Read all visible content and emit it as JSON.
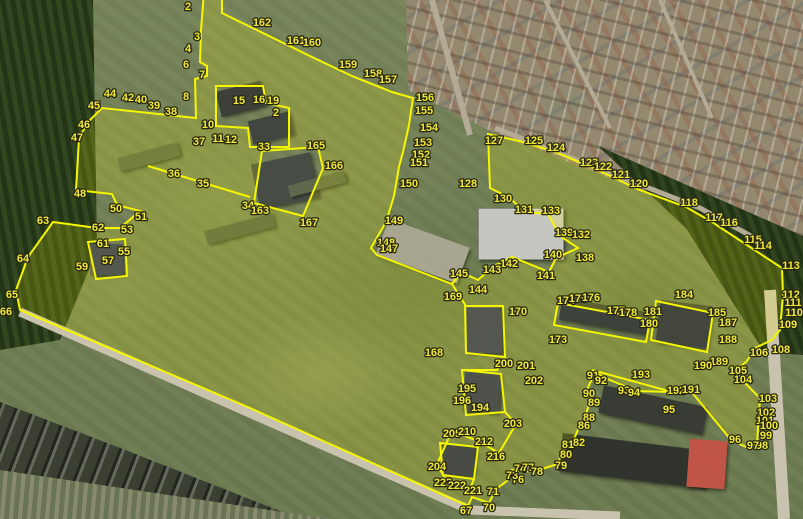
{
  "map": {
    "description": "Aerial cadastral survey overlay with numbered parcel vertices",
    "colors": {
      "boundary": "#f6f600",
      "parcel_fill": "rgba(255,255,0,0.17)",
      "label_text": "#f0e93a",
      "label_outline": "#262612",
      "road": "#c9c2ae",
      "road_minor": "#b3ab95"
    },
    "points": [
      [
        "2",
        188,
        6
      ],
      [
        "162",
        262,
        22
      ],
      [
        "3",
        197,
        36
      ],
      [
        "4",
        188,
        48
      ],
      [
        "6",
        186,
        64
      ],
      [
        "7",
        202,
        74
      ],
      [
        "8",
        186,
        96
      ],
      [
        "44",
        110,
        93
      ],
      [
        "45",
        94,
        105
      ],
      [
        "42",
        128,
        97
      ],
      [
        "40",
        141,
        99
      ],
      [
        "39",
        154,
        105
      ],
      [
        "38",
        171,
        111
      ],
      [
        "46",
        84,
        124
      ],
      [
        "47",
        77,
        137
      ],
      [
        "48",
        80,
        193
      ],
      [
        "50",
        116,
        208
      ],
      [
        "51",
        141,
        216
      ],
      [
        "62",
        98,
        227
      ],
      [
        "53",
        127,
        229
      ],
      [
        "63",
        43,
        220
      ],
      [
        "61",
        103,
        243
      ],
      [
        "55",
        124,
        251
      ],
      [
        "64",
        23,
        258
      ],
      [
        "57",
        108,
        260
      ],
      [
        "59",
        82,
        266
      ],
      [
        "65",
        12,
        294
      ],
      [
        "66",
        6,
        311
      ],
      [
        "161",
        296,
        40
      ],
      [
        "160",
        312,
        42
      ],
      [
        "159",
        348,
        64
      ],
      [
        "158",
        373,
        73
      ],
      [
        "157",
        388,
        79
      ],
      [
        "156",
        425,
        97
      ],
      [
        "155",
        424,
        110
      ],
      [
        "154",
        429,
        127
      ],
      [
        "153",
        423,
        142
      ],
      [
        "152",
        421,
        154
      ],
      [
        "151",
        419,
        162
      ],
      [
        "150",
        409,
        183
      ],
      [
        "149",
        394,
        220
      ],
      [
        "148",
        386,
        242
      ],
      [
        "147",
        389,
        248
      ],
      [
        "15",
        239,
        100
      ],
      [
        "16",
        259,
        99
      ],
      [
        "19",
        273,
        100
      ],
      [
        "2",
        276,
        112
      ],
      [
        "10",
        208,
        124
      ],
      [
        "11",
        218,
        138
      ],
      [
        "12",
        231,
        139
      ],
      [
        "37",
        199,
        141
      ],
      [
        "36",
        174,
        173
      ],
      [
        "35",
        203,
        183
      ],
      [
        "33",
        264,
        146
      ],
      [
        "34",
        248,
        205
      ],
      [
        "163",
        260,
        210
      ],
      [
        "165",
        316,
        145
      ],
      [
        "166",
        334,
        165
      ],
      [
        "167",
        309,
        222
      ],
      [
        "127",
        494,
        140
      ],
      [
        "125",
        534,
        140
      ],
      [
        "124",
        556,
        147
      ],
      [
        "123",
        589,
        162
      ],
      [
        "122",
        603,
        166
      ],
      [
        "121",
        621,
        174
      ],
      [
        "120",
        639,
        183
      ],
      [
        "128",
        468,
        183
      ],
      [
        "130",
        503,
        198
      ],
      [
        "118",
        689,
        202
      ],
      [
        "117",
        714,
        217
      ],
      [
        "116",
        729,
        222
      ],
      [
        "115",
        753,
        239
      ],
      [
        "114",
        763,
        245
      ],
      [
        "113",
        791,
        265
      ],
      [
        "112",
        791,
        294
      ],
      [
        "111",
        793,
        302
      ],
      [
        "110",
        794,
        312
      ],
      [
        "109",
        788,
        324
      ],
      [
        "108",
        781,
        349
      ],
      [
        "106",
        759,
        352
      ],
      [
        "105",
        738,
        370
      ],
      [
        "104",
        743,
        379
      ],
      [
        "103",
        768,
        398
      ],
      [
        "102",
        766,
        412
      ],
      [
        "101",
        765,
        420
      ],
      [
        "100",
        769,
        425
      ],
      [
        "99",
        766,
        435
      ],
      [
        "98",
        762,
        445
      ],
      [
        "97",
        753,
        445
      ],
      [
        "96",
        735,
        439
      ],
      [
        "95",
        669,
        409
      ],
      [
        "131",
        524,
        209
      ],
      [
        "133",
        551,
        210
      ],
      [
        "139",
        564,
        232
      ],
      [
        "132",
        581,
        234
      ],
      [
        "140",
        553,
        254
      ],
      [
        "138",
        585,
        257
      ],
      [
        "141",
        546,
        275
      ],
      [
        "142",
        509,
        263
      ],
      [
        "143",
        492,
        269
      ],
      [
        "144",
        478,
        289
      ],
      [
        "145",
        459,
        273
      ],
      [
        "169",
        453,
        296
      ],
      [
        "170",
        518,
        311
      ],
      [
        "174",
        566,
        300
      ],
      [
        "175",
        578,
        298
      ],
      [
        "176",
        591,
        297
      ],
      [
        "177",
        616,
        310
      ],
      [
        "178",
        628,
        312
      ],
      [
        "181",
        653,
        311
      ],
      [
        "180",
        649,
        323
      ],
      [
        "184",
        684,
        294
      ],
      [
        "185",
        717,
        312
      ],
      [
        "187",
        728,
        322
      ],
      [
        "188",
        728,
        339
      ],
      [
        "173",
        558,
        339
      ],
      [
        "189",
        719,
        361
      ],
      [
        "190",
        703,
        365
      ],
      [
        "192",
        676,
        390
      ],
      [
        "191",
        691,
        389
      ],
      [
        "193",
        641,
        374
      ],
      [
        "168",
        434,
        352
      ],
      [
        "200",
        504,
        363
      ],
      [
        "201",
        526,
        365
      ],
      [
        "202",
        534,
        380
      ],
      [
        "195",
        467,
        388
      ],
      [
        "196",
        462,
        400
      ],
      [
        "194",
        480,
        407
      ],
      [
        "203",
        513,
        423
      ],
      [
        "91",
        593,
        375
      ],
      [
        "92",
        601,
        380
      ],
      [
        "93",
        624,
        390
      ],
      [
        "94",
        634,
        392
      ],
      [
        "90",
        589,
        393
      ],
      [
        "89",
        594,
        402
      ],
      [
        "88",
        589,
        417
      ],
      [
        "86",
        584,
        425
      ],
      [
        "82",
        579,
        442
      ],
      [
        "81",
        568,
        444
      ],
      [
        "80",
        566,
        454
      ],
      [
        "79",
        561,
        465
      ],
      [
        "76",
        518,
        479
      ],
      [
        "73",
        512,
        475
      ],
      [
        "74",
        520,
        468
      ],
      [
        "77",
        528,
        467
      ],
      [
        "78",
        537,
        471
      ],
      [
        "71",
        493,
        491
      ],
      [
        "70",
        489,
        507
      ],
      [
        "67",
        466,
        510
      ],
      [
        "205",
        452,
        433
      ],
      [
        "210",
        467,
        431
      ],
      [
        "212",
        484,
        441
      ],
      [
        "216",
        496,
        456
      ],
      [
        "204",
        437,
        466
      ],
      [
        "223",
        443,
        482
      ],
      [
        "222",
        457,
        485
      ],
      [
        "221",
        473,
        490
      ]
    ],
    "outline": [
      [
        204,
        -8
      ],
      [
        201,
        30
      ],
      [
        200,
        62
      ],
      [
        207,
        66
      ],
      [
        207,
        76
      ],
      [
        195,
        79
      ],
      [
        196,
        118
      ],
      [
        102,
        108
      ],
      [
        88,
        122
      ],
      [
        79,
        138
      ],
      [
        76,
        190
      ],
      [
        112,
        194
      ],
      [
        117,
        205
      ],
      [
        140,
        211
      ],
      [
        120,
        228
      ],
      [
        97,
        228
      ],
      [
        53,
        222
      ],
      [
        28,
        257
      ],
      [
        16,
        290
      ],
      [
        20,
        310
      ],
      [
        250,
        408
      ],
      [
        468,
        506
      ],
      [
        472,
        497
      ],
      [
        489,
        503
      ],
      [
        496,
        489
      ],
      [
        507,
        481
      ],
      [
        512,
        470
      ],
      [
        536,
        472
      ],
      [
        545,
        468
      ],
      [
        558,
        464
      ],
      [
        563,
        450
      ],
      [
        572,
        444
      ],
      [
        580,
        425
      ],
      [
        585,
        417
      ],
      [
        590,
        402
      ],
      [
        587,
        390
      ],
      [
        595,
        372
      ],
      [
        605,
        378
      ],
      [
        622,
        385
      ],
      [
        635,
        391
      ],
      [
        672,
        392
      ],
      [
        690,
        390
      ],
      [
        731,
        440
      ],
      [
        746,
        447
      ],
      [
        757,
        444
      ],
      [
        760,
        398
      ],
      [
        743,
        381
      ],
      [
        735,
        371
      ],
      [
        747,
        361
      ],
      [
        755,
        348
      ],
      [
        772,
        340
      ],
      [
        780,
        330
      ],
      [
        783,
        295
      ],
      [
        782,
        268
      ],
      [
        750,
        247
      ],
      [
        712,
        222
      ],
      [
        686,
        207
      ],
      [
        637,
        189
      ],
      [
        617,
        179
      ],
      [
        591,
        167
      ],
      [
        553,
        151
      ],
      [
        519,
        141
      ],
      [
        488,
        134
      ],
      [
        490,
        188
      ],
      [
        510,
        198
      ],
      [
        524,
        212
      ],
      [
        548,
        214
      ],
      [
        560,
        236
      ],
      [
        578,
        248
      ],
      [
        556,
        258
      ],
      [
        549,
        272
      ],
      [
        512,
        257
      ],
      [
        494,
        266
      ],
      [
        478,
        280
      ],
      [
        461,
        272
      ],
      [
        452,
        284
      ],
      [
        377,
        255
      ],
      [
        371,
        248
      ],
      [
        386,
        222
      ],
      [
        394,
        196
      ],
      [
        399,
        167
      ],
      [
        403,
        152
      ],
      [
        409,
        125
      ],
      [
        413,
        98
      ],
      [
        392,
        92
      ],
      [
        352,
        76
      ],
      [
        312,
        57
      ],
      [
        222,
        13
      ],
      [
        222,
        -8
      ]
    ],
    "holes": [
      [
        [
          216,
          86
        ],
        [
          263,
          86
        ],
        [
          266,
          103
        ],
        [
          289,
          108
        ],
        [
          289,
          147
        ],
        [
          250,
          147
        ],
        [
          248,
          128
        ],
        [
          216,
          126
        ]
      ],
      [
        [
          262,
          151
        ],
        [
          318,
          147
        ],
        [
          323,
          168
        ],
        [
          303,
          216
        ],
        [
          254,
          203
        ]
      ],
      [
        [
          88,
          242
        ],
        [
          125,
          239
        ],
        [
          127,
          276
        ],
        [
          96,
          279
        ]
      ],
      [
        [
          465,
          306
        ],
        [
          503,
          306
        ],
        [
          505,
          357
        ],
        [
          466,
          353
        ]
      ],
      [
        [
          462,
          370
        ],
        [
          501,
          374
        ],
        [
          505,
          412
        ],
        [
          466,
          415
        ]
      ],
      [
        [
          440,
          443
        ],
        [
          478,
          447
        ],
        [
          474,
          479
        ],
        [
          443,
          475
        ]
      ],
      [
        [
          558,
          303
        ],
        [
          650,
          320
        ],
        [
          646,
          342
        ],
        [
          554,
          325
        ]
      ],
      [
        [
          656,
          301
        ],
        [
          713,
          313
        ],
        [
          707,
          352
        ],
        [
          651,
          340
        ]
      ]
    ],
    "lines": [
      [
        [
          148,
          166
        ],
        [
          250,
          197
        ]
      ],
      [
        [
          592,
          370
        ],
        [
          676,
          393
        ]
      ],
      [
        [
          452,
          284
        ],
        [
          466,
          306
        ]
      ],
      [
        [
          505,
          357
        ],
        [
          497,
          370
        ],
        [
          462,
          370
        ]
      ],
      [
        [
          505,
          412
        ],
        [
          516,
          424
        ],
        [
          499,
          453
        ],
        [
          478,
          441
        ],
        [
          452,
          431
        ],
        [
          437,
          464
        ],
        [
          446,
          480
        ],
        [
          470,
          489
        ],
        [
          474,
          479
        ]
      ]
    ],
    "roads": [
      {
        "pts": [
          [
            20,
            312
          ],
          [
            470,
            510
          ],
          [
            620,
            516
          ]
        ],
        "w": 9,
        "minor": false
      },
      {
        "pts": [
          [
            770,
            290
          ],
          [
            784,
            519
          ]
        ],
        "w": 12,
        "minor": false
      },
      {
        "pts": [
          [
            495,
            128
          ],
          [
            700,
            208
          ],
          [
            762,
            242
          ]
        ],
        "w": 5,
        "minor": true
      },
      {
        "pts": [
          [
            470,
            135
          ],
          [
            432,
            0
          ]
        ],
        "w": 6,
        "minor": true
      },
      {
        "pts": [
          [
            545,
            0
          ],
          [
            610,
            128
          ]
        ],
        "w": 4,
        "minor": true
      },
      {
        "pts": [
          [
            660,
            0
          ],
          [
            712,
            118
          ]
        ],
        "w": 4,
        "minor": true
      }
    ]
  }
}
